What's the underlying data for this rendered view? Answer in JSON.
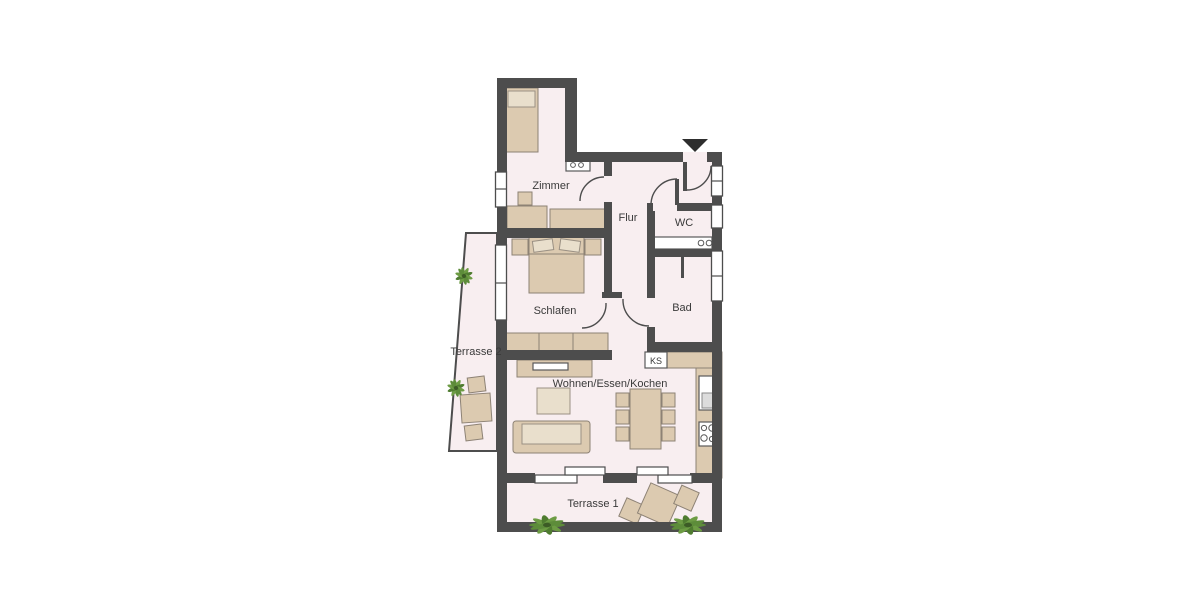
{
  "plan": {
    "room_labels": {
      "zimmer": "Zimmer",
      "flur": "Flur",
      "wc": "WC",
      "schlafen": "Schlafen",
      "bad": "Bad",
      "wohnen": "Wohnen/Essen/Kochen",
      "terrasse1": "Terrasse 1",
      "terrasse2": "Terrasse 2",
      "ks": "KS"
    },
    "colors": {
      "background": "#ffffff",
      "wall": "#4d4d4d",
      "floor": "#f8eef0",
      "furniture": "#dccab0",
      "furniture_light": "#e9dfcc",
      "plant": "#5d8c3a",
      "text": "#3a3a3a"
    }
  }
}
